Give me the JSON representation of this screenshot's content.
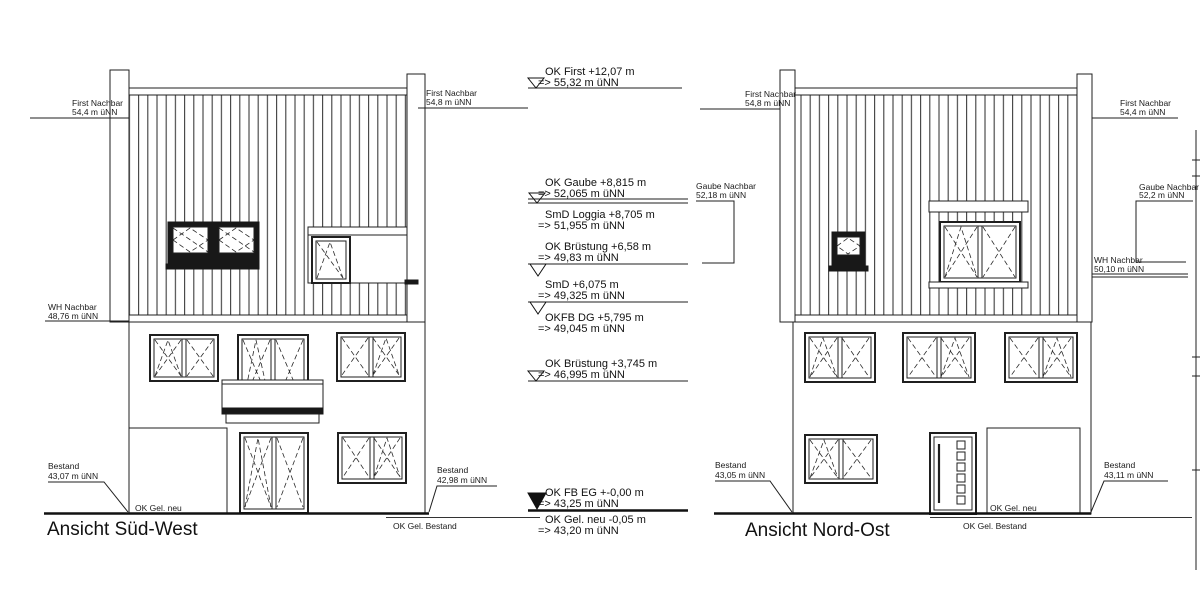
{
  "drawing": {
    "left_elevation": {
      "title": "Ansicht Süd-West",
      "labels": {
        "first_nachbar_left": {
          "line1": "First Nachbar",
          "line2": "54,4 m üNN"
        },
        "first_nachbar_right": {
          "line1": "First Nachbar",
          "line2": "54,8 m üNN"
        },
        "wh_nachbar": {
          "line1": "WH Nachbar",
          "line2": "48,76 m üNN"
        },
        "bestand_left": {
          "line1": "Bestand",
          "line2": "43,07 m üNN"
        },
        "bestand_right": {
          "line1": "Bestand",
          "line2": "42,98 m üNN"
        },
        "ok_gel_neu": "OK Gel. neu",
        "ok_gel_bestand": "OK Gel. Bestand"
      }
    },
    "right_elevation": {
      "title": "Ansicht Nord-Ost",
      "labels": {
        "first_nachbar_left": {
          "line1": "First Nachbar",
          "line2": "54,8 m üNN"
        },
        "gaube_nachbar_left": {
          "line1": "Gaube Nachbar",
          "line2": "52,18 m üNN"
        },
        "first_nachbar_right": {
          "line1": "First Nachbar",
          "line2": "54,4 m üNN"
        },
        "gaube_nachbar_right": {
          "line1": "Gaube Nachbar",
          "line2": "52,2 m üNN"
        },
        "wh_nachbar_right": {
          "line1": "WH Nachbar",
          "line2": "50,10 m üNN"
        },
        "bestand_left": {
          "line1": "Bestand",
          "line2": "43,05 m üNN"
        },
        "bestand_right": {
          "line1": "Bestand",
          "line2": "43,11 m üNN"
        },
        "ok_gel_neu": "OK Gel. neu",
        "ok_gel_bestand": "OK Gel. Bestand"
      }
    },
    "levels": [
      {
        "label": "OK First +12,07 m",
        "value": "=> 55,32 m üNN"
      },
      {
        "label": "OK Gaube +8,815 m",
        "value": "=> 52,065 m üNN"
      },
      {
        "label": "SmD Loggia +8,705 m",
        "value": "=> 51,955 m üNN"
      },
      {
        "label": "OK Brüstung +6,58 m",
        "value": "=> 49,83 m üNN"
      },
      {
        "label": "SmD +6,075 m",
        "value": "=> 49,325 m üNN"
      },
      {
        "label": "OKFB DG +5,795 m",
        "value": "=> 49,045 m üNN"
      },
      {
        "label": "OK Brüstung +3,745 m",
        "value": "=> 46,995 m üNN"
      },
      {
        "label": "OK FB EG +-0,00 m",
        "value": "=> 43,25 m üNN"
      },
      {
        "label": "OK Gel. neu -0,05 m",
        "value": "=> 43,20 m üNN"
      }
    ]
  }
}
